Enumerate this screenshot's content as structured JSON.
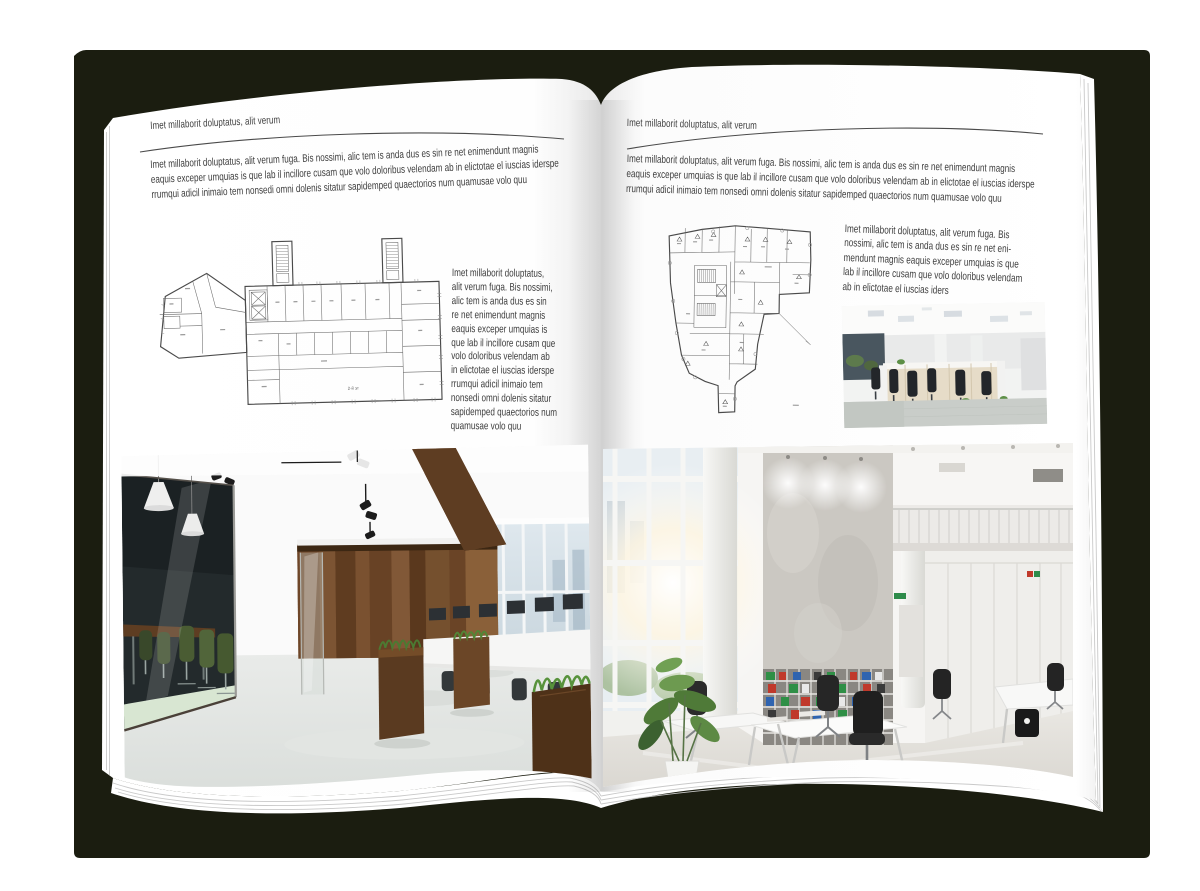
{
  "palette": {
    "shadow": "#1b1d10",
    "page": "#ffffff",
    "text": "#3d3d3d",
    "rule": "#4a4a4a",
    "plan": "#4a4a4a",
    "wood_dark": "#5e3d22",
    "wood_light": "#7c5433",
    "chair_green": "#4a5c33",
    "binder_green": "#2f8f46",
    "binder_red": "#c0392b",
    "binder_blue": "#2f64b0"
  },
  "left_page": {
    "header": "Imet millaborit doluptatus, alit verum",
    "intro": "Imet millaborit doluptatus, alit verum fuga. Bis nossimi, alic tem is anda dus es sin re net enimendunt magnis\neaquis exceper umquias is que lab il incillore cusam que volo doloribus velendam ab in elictotae el iuscias iderspe\nrrumqui adicil inimaio tem nonsedi omni dolenis sitatur sapidemped quaectorios num quamusae volo quu",
    "side_text": "Imet millaborit doluptatus,\nalit verum fuga. Bis nossimi,\nalic tem is anda dus es sin\nre net enimendunt magnis\neaquis exceper umquias is\nque lab il incillore cusam que\nvolo doloribus velendam ab\nin elictotae el iuscias iderspe\nrrumqui adicil inimaio tem\nnonsedi omni dolenis sitatur\nsapidemped quaectorios num\nquamusae volo quu",
    "floor_plan_label": "2-й эт",
    "photo_description": "Modern office interior with glass meeting room, green chairs, dark wood wall, planter desks and concrete floor"
  },
  "right_page": {
    "header": "Imet millaborit doluptatus, alit verum",
    "intro": "Imet millaborit doluptatus, alit verum fuga. Bis nossimi, alic tem is anda dus es sin re net enimendunt magnis\neaquis exceper umquias is que lab il incillore cusam que volo doloribus velendam ab in elictotae el iuscias iderspe\nrrumqui adicil inimaio tem nonsedi omni dolenis sitatur sapidemped quaectorios num quamusae volo quu",
    "side_text": "Imet millaborit doluptatus, alit verum fuga. Bis\nnossimi, alic tem is anda dus es sin re net eni-\nmendunt magnis eaquis exceper umquias is que\nlab il incillore cusam que volo doloribus velendam\nab in elictotae el iuscias iders",
    "photo_small_description": "Open-plan office with rows of desks, black chairs, wooden cabinets and panel ceiling lights",
    "photo_large_description": "Bright double-height office with window wall, concrete feature wall, shelves of colorful binders and white desks"
  }
}
